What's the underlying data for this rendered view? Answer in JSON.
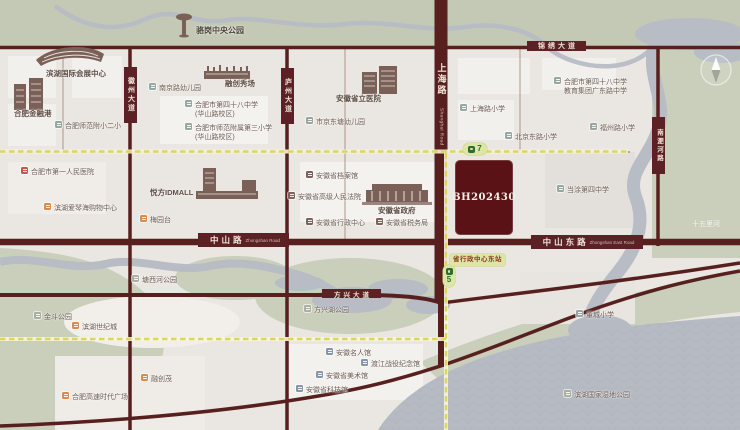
{
  "plot": {
    "label": "BH202430",
    "color": "#5a1216"
  },
  "roads": {
    "jinxiu": "锦绣大道",
    "fangxing": "方兴大道",
    "huizhou": "徽州大道",
    "luzhou": "庐州大道",
    "nanfeihe": "南淝河路",
    "shanghai_zh": "上海路",
    "shanghai_en": "Shanghai Road",
    "zhongshan_zh": "中山路",
    "zhongshan_en": "Zhongshan Road",
    "zhongshan_east_zh": "中山东路",
    "zhongshan_east_en": "Zhongshan East Road"
  },
  "metro": {
    "line7": "7",
    "line5": "5",
    "station_east": "省行政中心东站",
    "line_color": "#dcd75c",
    "badge_bg": "#dde6a4"
  },
  "pois": [
    {
      "id": "luogang-park",
      "type": "plain",
      "variant": "bold",
      "x": 196,
      "y": 26,
      "label": "骆岗中央公园"
    },
    {
      "id": "convention-center",
      "type": "plain",
      "x": 46,
      "y": 69,
      "label": "滨湖国际会展中心"
    },
    {
      "id": "finance-port",
      "type": "plain",
      "x": 14,
      "y": 109,
      "label": "合肥金融港"
    },
    {
      "id": "rongchuang-show",
      "type": "plain",
      "x": 225,
      "y": 79,
      "label": "融创秀场"
    },
    {
      "id": "nanjing-rd-kindergarten",
      "type": "school",
      "x": 149,
      "y": 84,
      "label": "南京路幼儿园"
    },
    {
      "id": "no48-middle-huashan",
      "type": "school",
      "x": 185,
      "y": 101,
      "label": "合肥市第四十八中学",
      "label2": "(华山路校区)"
    },
    {
      "id": "shifan-no3-primary",
      "type": "school",
      "x": 185,
      "y": 124,
      "label": "合肥市师范附属第三小学",
      "label2": "(华山路校区)"
    },
    {
      "id": "shifan-fuxiao-2",
      "type": "school",
      "x": 55,
      "y": 122,
      "label": "合肥师范附小二小"
    },
    {
      "id": "first-people-hospital",
      "type": "hospital",
      "x": 21,
      "y": 168,
      "label": "合肥市第一人民医院"
    },
    {
      "id": "aiqinhai-mall",
      "type": "shop",
      "x": 44,
      "y": 204,
      "label": "滨湖爱琴海购物中心"
    },
    {
      "id": "idmall",
      "type": "plain",
      "x": 150,
      "y": 188,
      "label": "悦方IDMALL"
    },
    {
      "id": "meiyuantai",
      "type": "shop",
      "x": 140,
      "y": 216,
      "label": "梅园台"
    },
    {
      "id": "prov-hospital",
      "type": "plain",
      "x": 336,
      "y": 94,
      "label": "安徽省立医院"
    },
    {
      "id": "city-kindergarten",
      "type": "school",
      "x": 306,
      "y": 118,
      "label": "市京东塘幼儿园"
    },
    {
      "id": "prov-archives",
      "type": "gov",
      "x": 306,
      "y": 172,
      "label": "安徽省档案馆"
    },
    {
      "id": "prov-high-court",
      "type": "gov",
      "x": 288,
      "y": 193,
      "label": "安徽省高级人民法院"
    },
    {
      "id": "prov-government",
      "type": "plain",
      "x": 378,
      "y": 206,
      "label": "安徽省政府"
    },
    {
      "id": "prov-admin-center",
      "type": "gov",
      "x": 306,
      "y": 219,
      "label": "安徽省行政中心"
    },
    {
      "id": "prov-tax-bureau",
      "type": "gov",
      "x": 376,
      "y": 219,
      "label": "安徽省税务局"
    },
    {
      "id": "shanghai-rd-primary",
      "type": "school",
      "x": 460,
      "y": 105,
      "label": "上海路小学"
    },
    {
      "id": "no48-guangdong",
      "type": "school",
      "x": 554,
      "y": 78,
      "label": "合肥市第四十八中学",
      "label2": "教育集团广东路中学"
    },
    {
      "id": "fuzhou-rd-primary",
      "type": "school",
      "x": 590,
      "y": 124,
      "label": "福州路小学"
    },
    {
      "id": "beijing-rd-primary",
      "type": "school",
      "x": 505,
      "y": 133,
      "label": "北京东路小学"
    },
    {
      "id": "dangtu-no4-middle",
      "type": "school",
      "x": 557,
      "y": 186,
      "label": "当涂第四中学"
    },
    {
      "id": "dongcheng-primary",
      "type": "school",
      "x": 576,
      "y": 311,
      "label": "董城小学"
    },
    {
      "id": "wetland-park",
      "type": "park",
      "x": 564,
      "y": 391,
      "label": "滨湖国家湿地公园"
    },
    {
      "id": "shiwuli-river",
      "type": "river",
      "variant": "white",
      "x": 692,
      "y": 220,
      "label": "十五里河"
    },
    {
      "id": "jindou-park",
      "type": "park",
      "x": 34,
      "y": 313,
      "label": "金斗公园"
    },
    {
      "id": "shijicheng",
      "type": "shop",
      "x": 72,
      "y": 323,
      "label": "滨湖世纪城"
    },
    {
      "id": "rongchuang-mao",
      "type": "shop",
      "x": 141,
      "y": 375,
      "label": "融创茂"
    },
    {
      "id": "gaosu-times-plaza",
      "type": "shop",
      "x": 62,
      "y": 393,
      "label": "合肥高速时代广场"
    },
    {
      "id": "tangxihe-park",
      "type": "park",
      "x": 132,
      "y": 276,
      "label": "塘西河公园"
    },
    {
      "id": "fangxinghu-park",
      "type": "park",
      "x": 304,
      "y": 306,
      "label": "方兴湖公园"
    },
    {
      "id": "celebrity-museum",
      "type": "museum",
      "x": 326,
      "y": 349,
      "label": "安徽名人馆"
    },
    {
      "id": "dujiang-memorial",
      "type": "museum",
      "x": 361,
      "y": 360,
      "label": "渡江战役纪念馆"
    },
    {
      "id": "art-museum",
      "type": "museum",
      "x": 316,
      "y": 372,
      "label": "安徽省美术馆"
    },
    {
      "id": "science-museum",
      "type": "museum",
      "x": 296,
      "y": 386,
      "label": "安徽省科技馆"
    }
  ]
}
